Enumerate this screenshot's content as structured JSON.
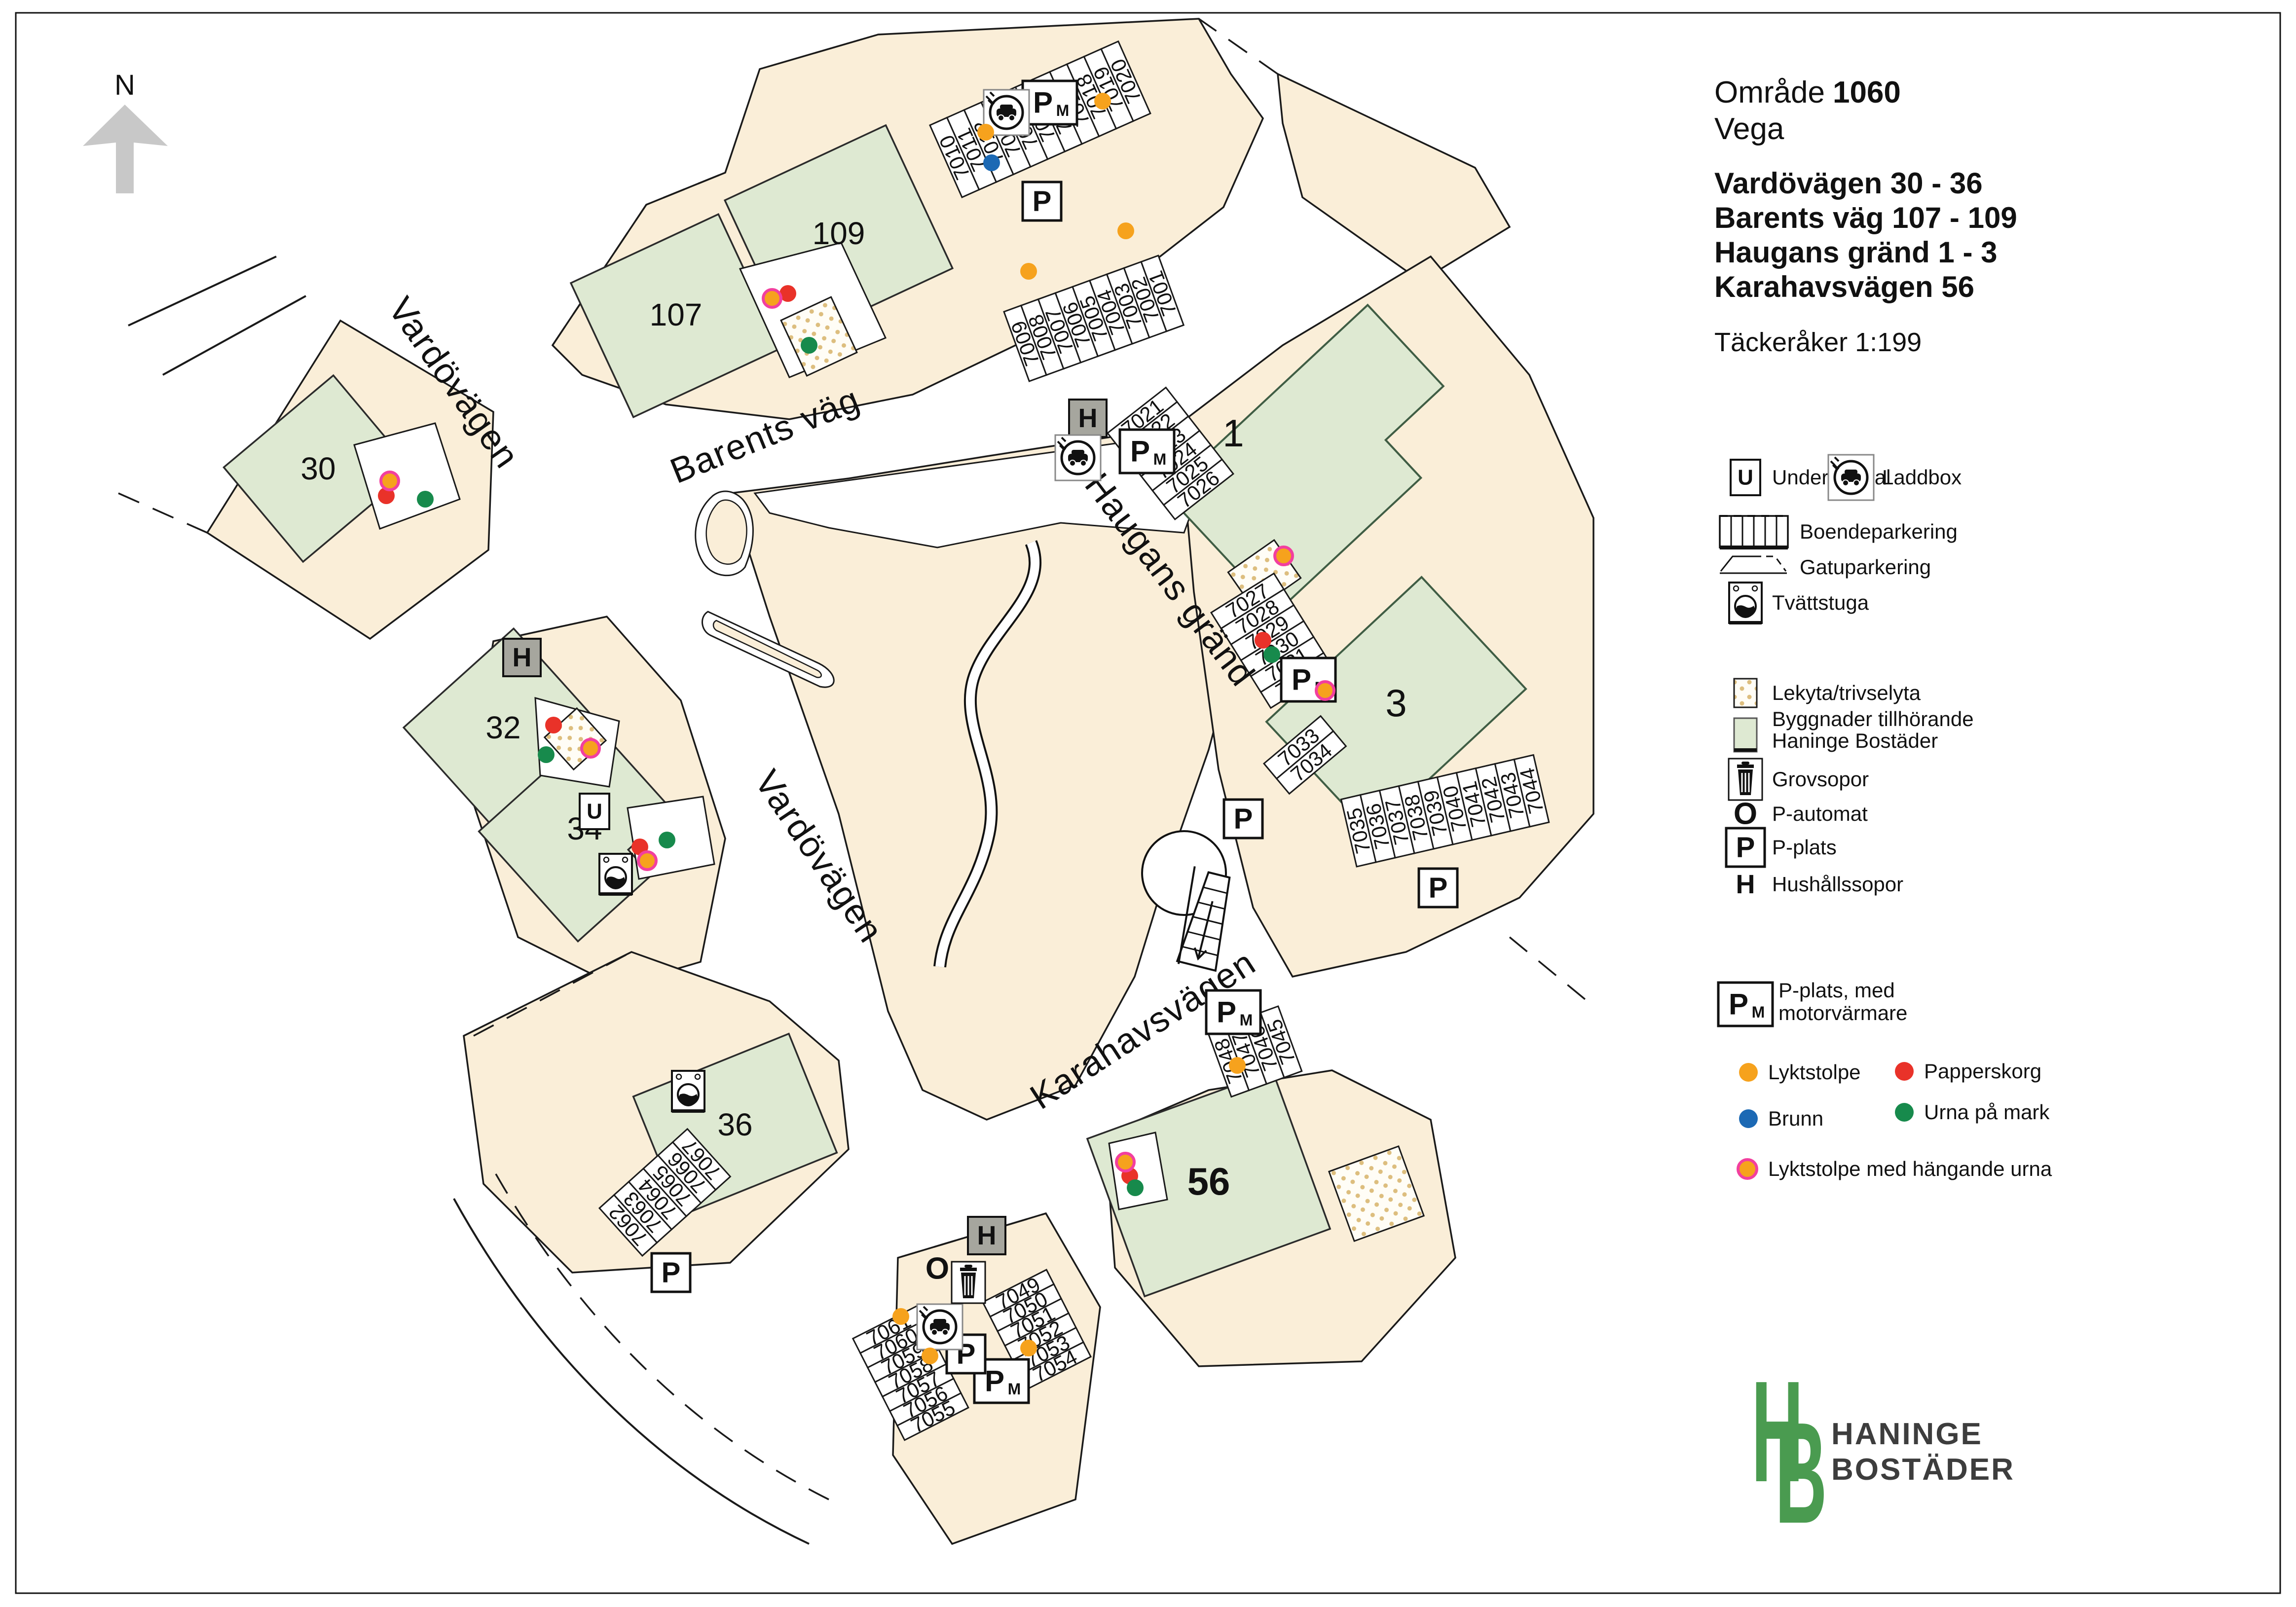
{
  "header": {
    "north": "N",
    "omrade_label": "Område",
    "omrade_number": "1060",
    "area_name": "Vega",
    "addresses": [
      "Vardövägen 30 - 36",
      "Barents väg 107 - 109",
      "Haugans gränd 1 - 3",
      "Karahavsvägen 56"
    ],
    "scale_note": "Täckeråker 1:199"
  },
  "icons": {
    "p": "P",
    "m": "M",
    "h": "H",
    "u": "U",
    "o": "O"
  },
  "legend": {
    "undercentral": "Undercentral",
    "laddbox": "Laddbox",
    "boendeparkering": "Boendeparkering",
    "gatuparkering": "Gatuparkering",
    "tvattstuga": "Tvättstuga",
    "lekyta": "Lekyta/trivselyta",
    "byggnader_line1": "Byggnader tillhörande",
    "byggnader_line2": "Haninge Bostäder",
    "grovsopor": "Grovsopor",
    "p_automat": "P-automat",
    "p_plats": "P-plats",
    "hushallssopor": "Hushållssopor",
    "p_plats_mv_line1": "P-plats, med",
    "p_plats_mv_line2": "motorvärmare",
    "lyktstolpe": "Lyktstolpe",
    "papperskorg": "Papperskorg",
    "brunn": "Brunn",
    "urna_pa_mark": "Urna på mark",
    "lyktstolpe_urna": "Lyktstolpe med hängande urna"
  },
  "logo": {
    "monogram_h": "H",
    "monogram_b": "B",
    "line1": "HANINGE",
    "line2": "BOSTÄDER"
  },
  "map": {
    "streets": [
      {
        "name": "Vardövägen"
      },
      {
        "name": "Barents väg"
      },
      {
        "name": "Vardövägen"
      },
      {
        "name": "Haugans gränd"
      },
      {
        "name": "Karahavsvägen"
      }
    ],
    "buildings": [
      {
        "number": "107"
      },
      {
        "number": "109"
      },
      {
        "number": "30"
      },
      {
        "number": "32"
      },
      {
        "number": "34"
      },
      {
        "number": "36"
      },
      {
        "number": "1"
      },
      {
        "number": "3"
      },
      {
        "number": "56"
      }
    ],
    "rows": {
      "a": [
        "7010",
        "7011",
        "7012",
        "7013",
        "7014",
        "7015",
        "7016",
        "7017",
        "7018",
        "7019",
        "7020"
      ],
      "b": [
        "7009",
        "7008",
        "7007",
        "7006",
        "7005",
        "7004",
        "7003",
        "7002",
        "7001"
      ],
      "c": [
        "7021",
        "7022",
        "7023",
        "7024",
        "7025",
        "7026"
      ],
      "d": [
        "7027",
        "7028",
        "7029",
        "7030",
        "7031",
        "7032"
      ],
      "e": [
        "7033",
        "7034"
      ],
      "f": [
        "7035",
        "7036",
        "7037",
        "7038",
        "7039",
        "7040",
        "7041",
        "7042",
        "7043",
        "7044"
      ],
      "g": [
        "7048",
        "7047",
        "7046",
        "7045"
      ],
      "h": [
        "7062",
        "7063",
        "7064",
        "7065",
        "7066",
        "7067"
      ],
      "i": [
        "7061",
        "7060",
        "7059",
        "7058",
        "7057",
        "7056",
        "7055"
      ],
      "j": [
        "7049",
        "7050",
        "7051",
        "7052",
        "7053",
        "7054"
      ]
    },
    "colors": {
      "parcel_beige": "#faeed8",
      "building_green": "#dee9d2",
      "lyktstolpe_orange": "#f6a21d",
      "papperskorg_red": "#e93229",
      "brunn_blue": "#1c69b4",
      "urna_green": "#178a4c",
      "hangande_urna_ring": "#f23f9f",
      "logo_green": "#4a9b50"
    }
  }
}
